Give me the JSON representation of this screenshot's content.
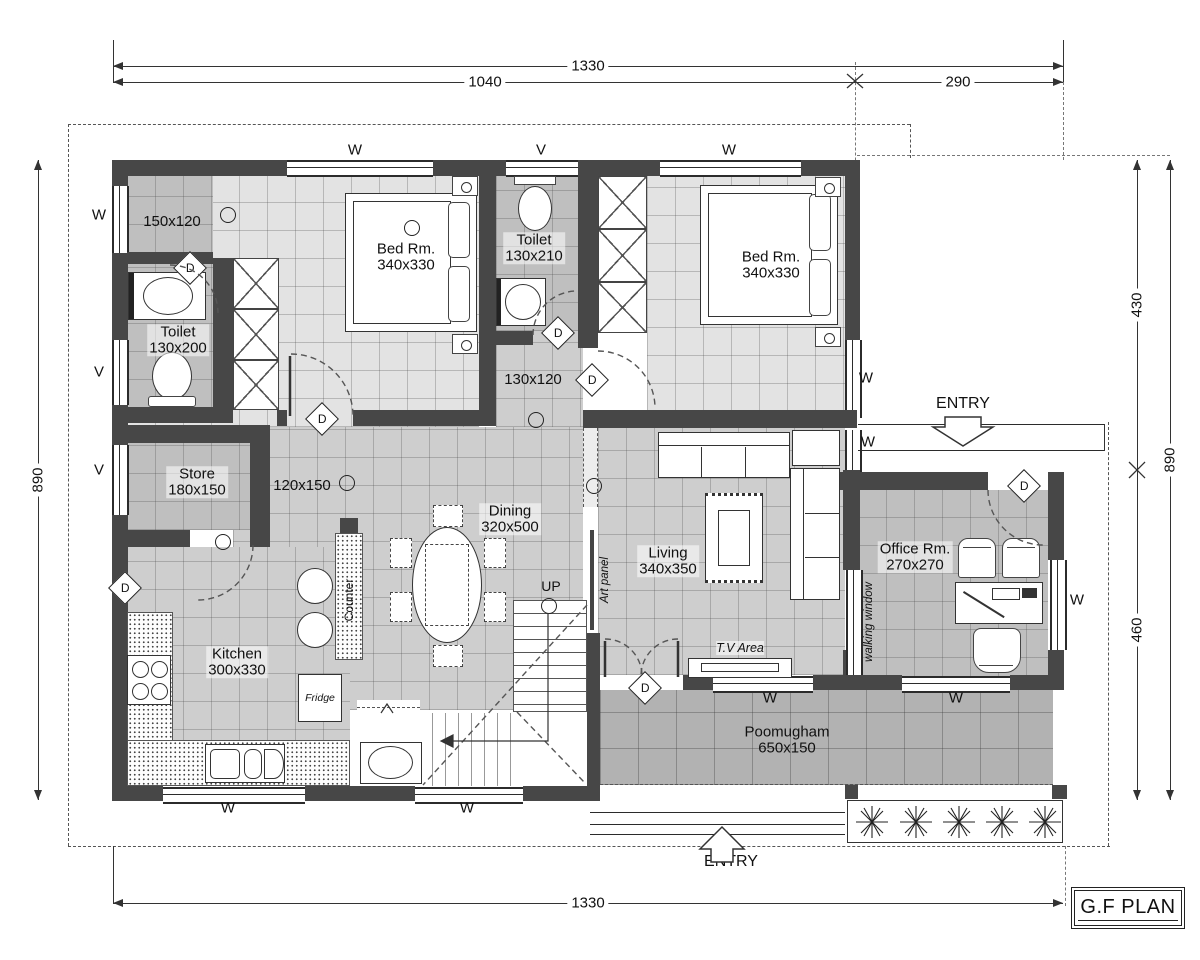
{
  "plan": {
    "title": "G.F PLAN",
    "dims": {
      "top_overall": "1330",
      "top_left": "1040",
      "top_right": "290",
      "left_overall": "890",
      "right_upper": "430",
      "right_lower": "460",
      "right_overall": "890",
      "bottom_overall": "1330"
    },
    "rooms": {
      "bed1": {
        "name": "Bed Rm.",
        "size": "340x330"
      },
      "bed2": {
        "name": "Bed Rm.",
        "size": "340x330"
      },
      "toilet1": {
        "name": "Toilet",
        "size": "130x200"
      },
      "toilet2": {
        "name": "Toilet",
        "size": "130x210"
      },
      "store": {
        "name": "Store",
        "size": "180x150"
      },
      "dining": {
        "name": "Dining",
        "size": "320x500"
      },
      "kitchen": {
        "name": "Kitchen",
        "size": "300x330"
      },
      "living": {
        "name": "Living",
        "size": "340x350"
      },
      "office": {
        "name": "Office Rm.",
        "size": "270x270"
      },
      "poomugham": {
        "name": "Poomugham",
        "size": "650x150"
      }
    },
    "passages": {
      "foyer": "150x120",
      "hall": "120x150",
      "lobby": "130x120"
    },
    "markers": {
      "door": "D",
      "window": "W",
      "vent": "V"
    },
    "annotations": {
      "up": "UP",
      "entry": "ENTRY",
      "counter": "Counter",
      "fridge": "Fridge",
      "art_panel": "Art panel",
      "walking_window": "walking window",
      "tv_area": "T.V Area"
    }
  }
}
